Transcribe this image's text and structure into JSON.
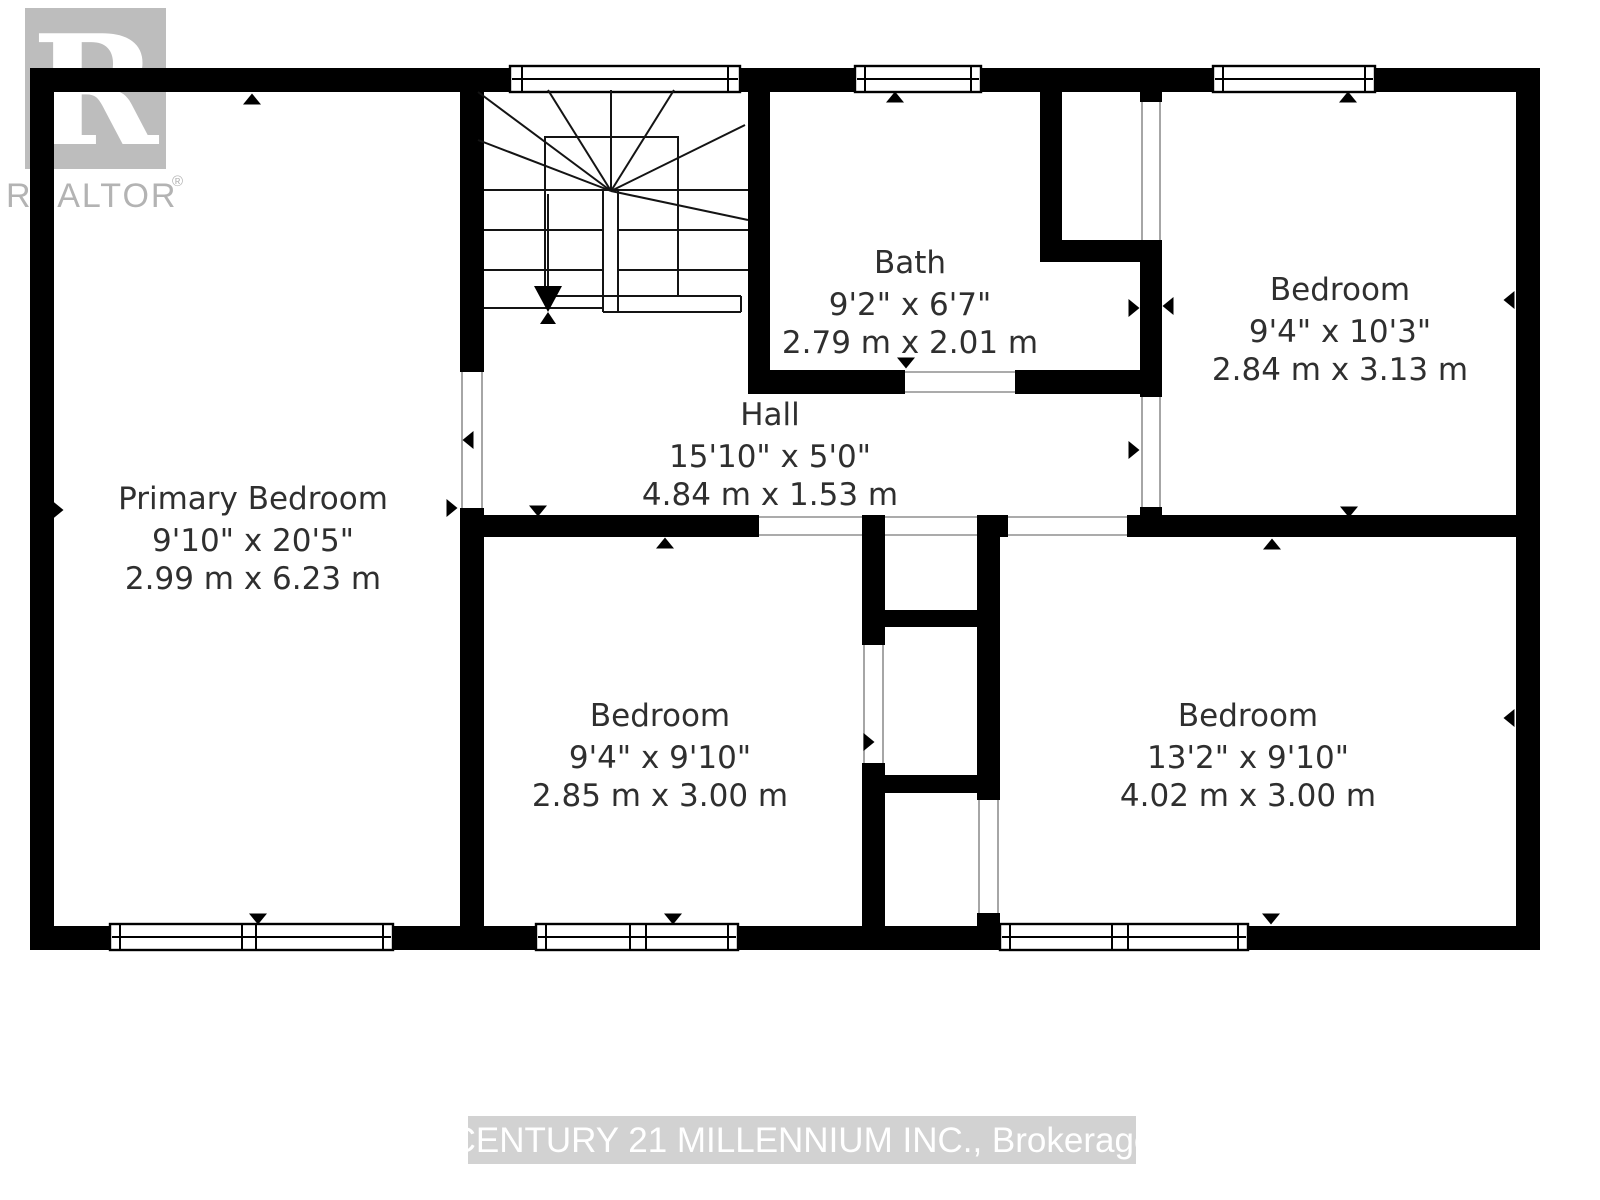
{
  "branding": {
    "logo_letter": "R",
    "logo_word": "REALTOR",
    "registered_mark": "®"
  },
  "watermark": {
    "text": "CENTURY 21 MILLENNIUM INC., Brokerage"
  },
  "rooms": [
    {
      "id": "primary-bedroom",
      "name": "Primary Bedroom",
      "imperial": "9'10\" x 20'5\"",
      "metric": "2.99 m x 6.23 m"
    },
    {
      "id": "bath",
      "name": "Bath",
      "imperial": "9'2\" x 6'7\"",
      "metric": "2.79 m x 2.01 m"
    },
    {
      "id": "bedroom-top-right",
      "name": "Bedroom",
      "imperial": "9'4\" x 10'3\"",
      "metric": "2.84 m x 3.13 m"
    },
    {
      "id": "hall",
      "name": "Hall",
      "imperial": "15'10\" x 5'0\"",
      "metric": "4.84 m x 1.53 m"
    },
    {
      "id": "bedroom-middle",
      "name": "Bedroom",
      "imperial": "9'4\" x 9'10\"",
      "metric": "2.85 m x 3.00 m"
    },
    {
      "id": "bedroom-right",
      "name": "Bedroom",
      "imperial": "13'2\" x 9'10\"",
      "metric": "4.02 m x 3.00 m"
    }
  ],
  "colors": {
    "wall": "#000000",
    "room_text": "#2f2f2f",
    "logo_gray": "#bdbdbd",
    "logo_text_gray": "#b3b3b3",
    "watermark_band": "#c3c3c3",
    "watermark_text": "#ffffff"
  }
}
